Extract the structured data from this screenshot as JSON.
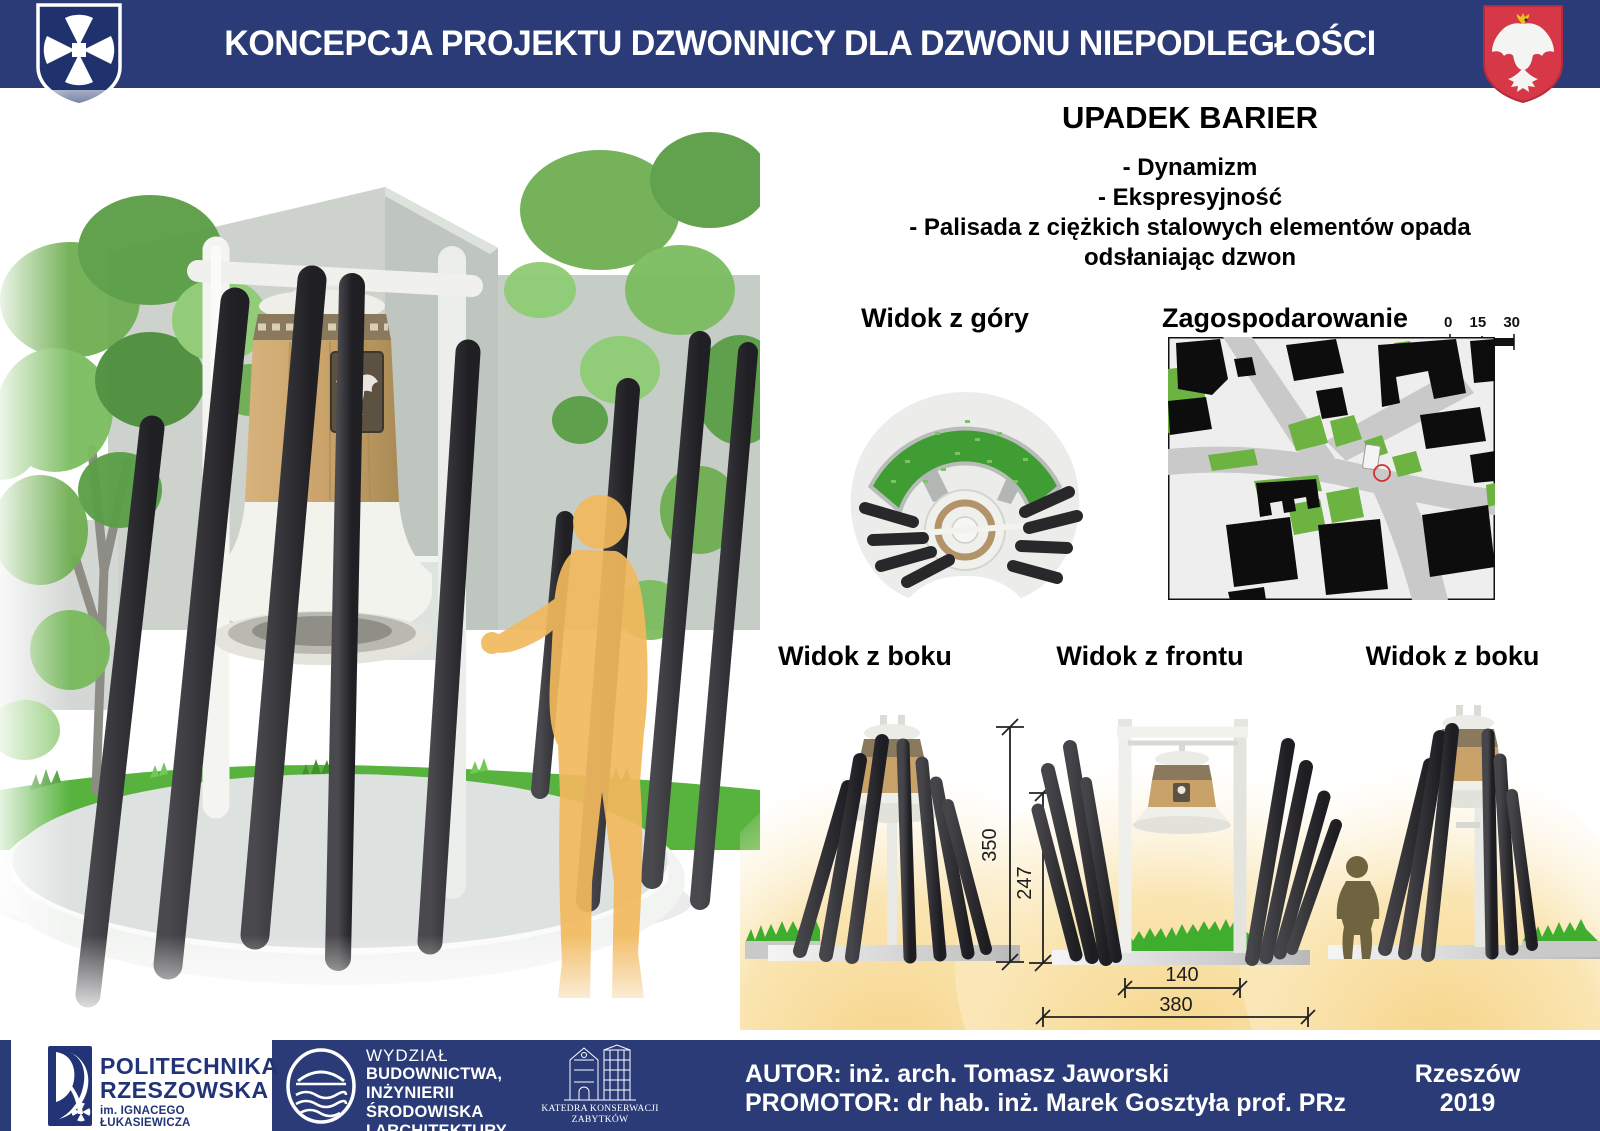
{
  "header": {
    "title": "KONCEPCJA PROJEKTU DZWONNICY DLA DZWONU NIEPODLEGŁOŚCI",
    "left_crest": "rzeszow-city-crest",
    "right_crest": "poland-coat-of-arms"
  },
  "concept": {
    "title": "UPADEK BARIER",
    "bullets": [
      "- Dynamizm",
      "- Ekspresyjność",
      "- Palisada z ciężkich stalowych elementów opada odsłaniając dzwon"
    ]
  },
  "views": {
    "top": "Widok z góry",
    "site_plan": "Zagospodarowanie",
    "side_left": "Widok z boku",
    "front": "Widok z frontu",
    "side_right": "Widok z boku",
    "scale_ticks": [
      "0",
      "15",
      "30"
    ]
  },
  "dimensions": {
    "total_height": "350",
    "bell_height": "247",
    "inner_width": "140",
    "total_width": "380"
  },
  "footer": {
    "university_line1": "POLITECHNIKA",
    "university_line2": "RZESZOWSKA",
    "university_line3": "im. IGNACEGO ŁUKASIEWICZA",
    "faculty_line1": "WYDZIAŁ",
    "faculty_line2": "BUDOWNICTWA,",
    "faculty_line3": "INŻYNIERII ŚRODOWISKA",
    "faculty_line4": "I ARCHITEKTURY",
    "faculty_line5": "POLITECHNIKI RZESZOWSKIEJ",
    "department_line1": "KATEDRA KONSERWACJI",
    "department_line2": "ZABYTKÓW",
    "author": "AUTOR: inż. arch. Tomasz Jaworski",
    "promoter": "PROMOTOR:  dr hab. inż. Marek Gosztyła prof. PRz",
    "city": "Rzeszów",
    "year": "2019"
  },
  "colors": {
    "navy": "#2a3b78",
    "crest_red": "#d63848",
    "map_green": "#6cb341",
    "steel_dark": "#2e2e31",
    "bell_bronze": "#c8a269",
    "glow_yellow": "#f6d488",
    "person_orange": "#f2b95d"
  }
}
